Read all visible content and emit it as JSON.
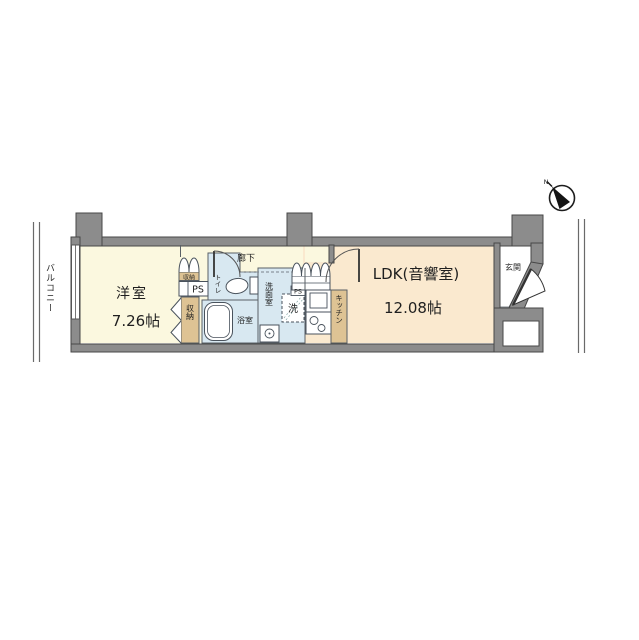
{
  "labels": {
    "balcony": "バルコニー",
    "corridor": "廊下",
    "western_room": "洋室",
    "western_room_size": "7.26帖",
    "ldk": "LDK(音響室)",
    "ldk_size": "12.08帖",
    "entrance": "玄関",
    "toilet": "トイレ",
    "bathroom": "浴室",
    "washroom": "洗面室",
    "kitchen": "キッチン",
    "storage": "収納",
    "storage_upper": "収納",
    "washer": "洗",
    "ps_1": "PS",
    "ps_2": "PS",
    "compass_north": "N"
  },
  "colors": {
    "wall_gray": "#8C8C8C",
    "room_cream": "#FBF8DF",
    "room_peach": "#FAE9CF",
    "wet_area_blue": "#D8E8F1",
    "fixture_tan": "#DEC394",
    "line_dark": "#474747"
  }
}
